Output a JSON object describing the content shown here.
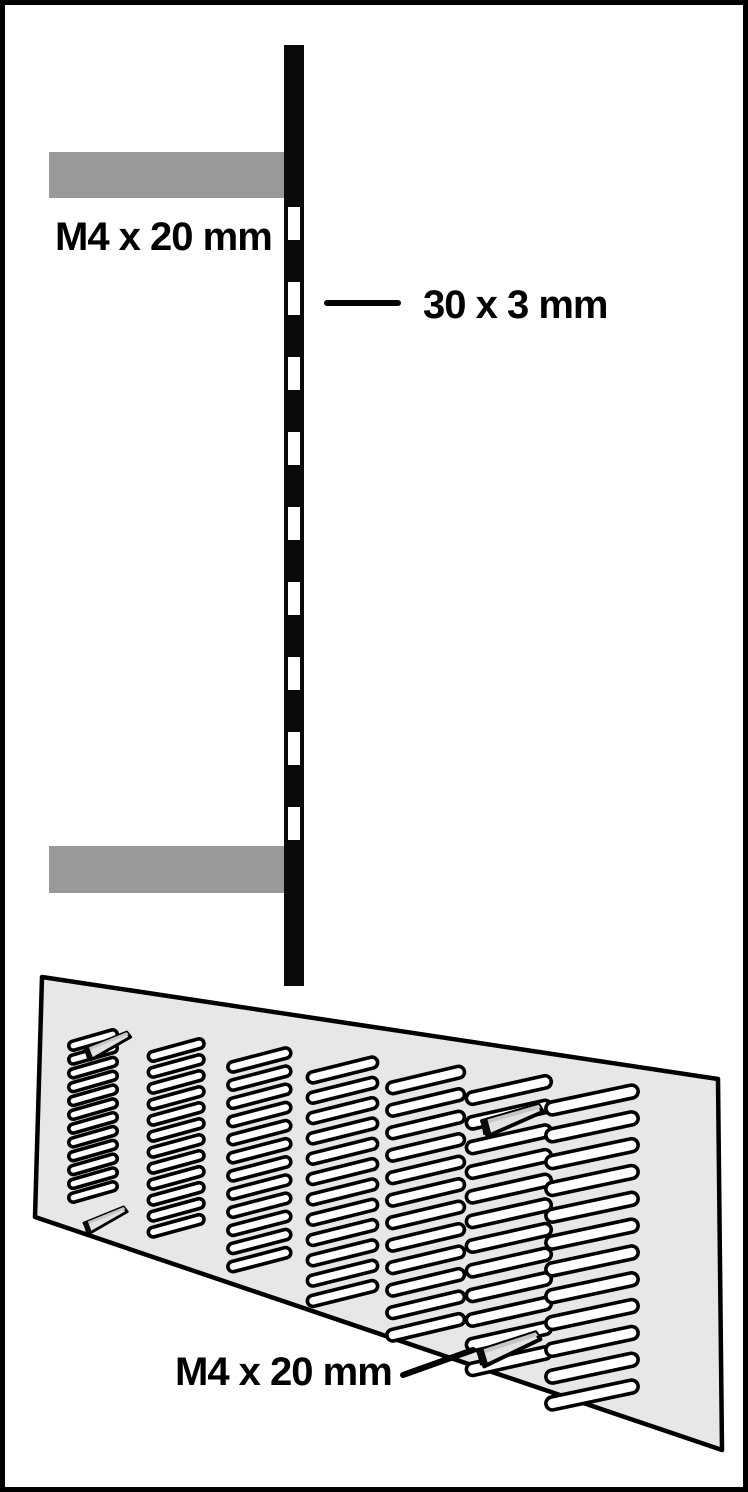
{
  "diagram": {
    "kind": "ventilation-grille-mounting-diagram"
  },
  "labels": {
    "top_screw": "M4 x 20 mm",
    "flat_bar": "30 x 3 mm",
    "bottom_screw": "M4 x 20 mm"
  },
  "colors": {
    "background": "#ffffff",
    "frame_black": "#000000",
    "bar_black": "#0a0a0a",
    "screw_gray": "#999999",
    "slot_white": "#ffffff",
    "plate_gray": "#e7e7e7",
    "stud_light": "#e2e2e2",
    "stud_mid": "#c6c6c6",
    "stud_tip_black": "#0a0a0a",
    "outline_black": "#000000"
  },
  "flat_bar": {
    "slot_count": 9
  },
  "grille": {
    "slot_columns": 7,
    "slot_rows": 12,
    "stud_count": 4
  }
}
